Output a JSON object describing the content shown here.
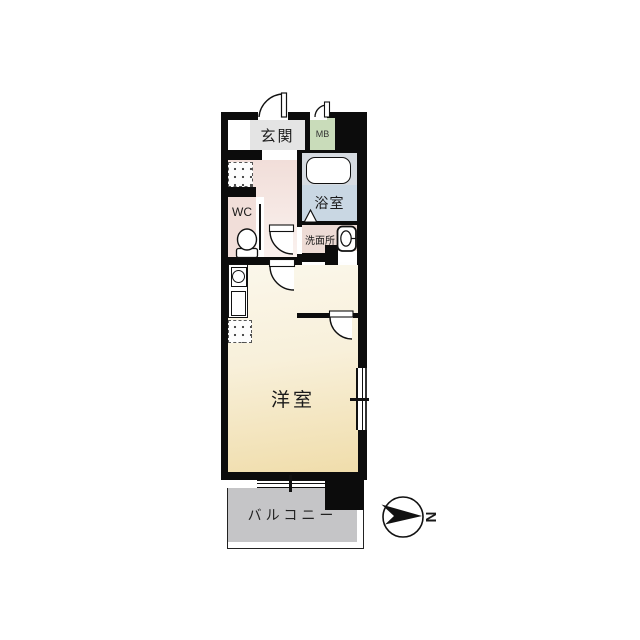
{
  "floorplan": {
    "title": "apartment-floor-plan",
    "rooms": {
      "genkan": {
        "label": "玄関"
      },
      "meter_box": {
        "label": "MB"
      },
      "bathroom": {
        "label": "浴室"
      },
      "washroom": {
        "label": "洗面所"
      },
      "toilet_room": {
        "label": "WC"
      },
      "walk_in_closet": {
        "label_line1": "ウォークイン",
        "label_line2": "クローゼット"
      },
      "western_room": {
        "label": "洋室"
      },
      "balcony": {
        "label": "バルコニー"
      }
    },
    "compass": {
      "label": "N"
    },
    "fixtures": [
      "bathtub",
      "toilet",
      "vanity-sink",
      "kitchenette",
      "refrigerator-space",
      "folding-bath-door",
      "swing-doors",
      "sliding-windows"
    ],
    "colors": {
      "wall": "#0c0c0c",
      "genkan": "#e4e4e4",
      "meter_box": "#c9dcba",
      "bathtub_area": "#d6dbe1",
      "bathroom": "#c9d7e3",
      "washroom": "#eddbd5",
      "wc": "#f1ded9",
      "hallway": "#f1ded9",
      "western_room_light": "#fbf7eb",
      "western_room_dark": "#f0ddab",
      "walk_in_closet": "#fefefe",
      "balcony": "#c5c5c7"
    }
  }
}
